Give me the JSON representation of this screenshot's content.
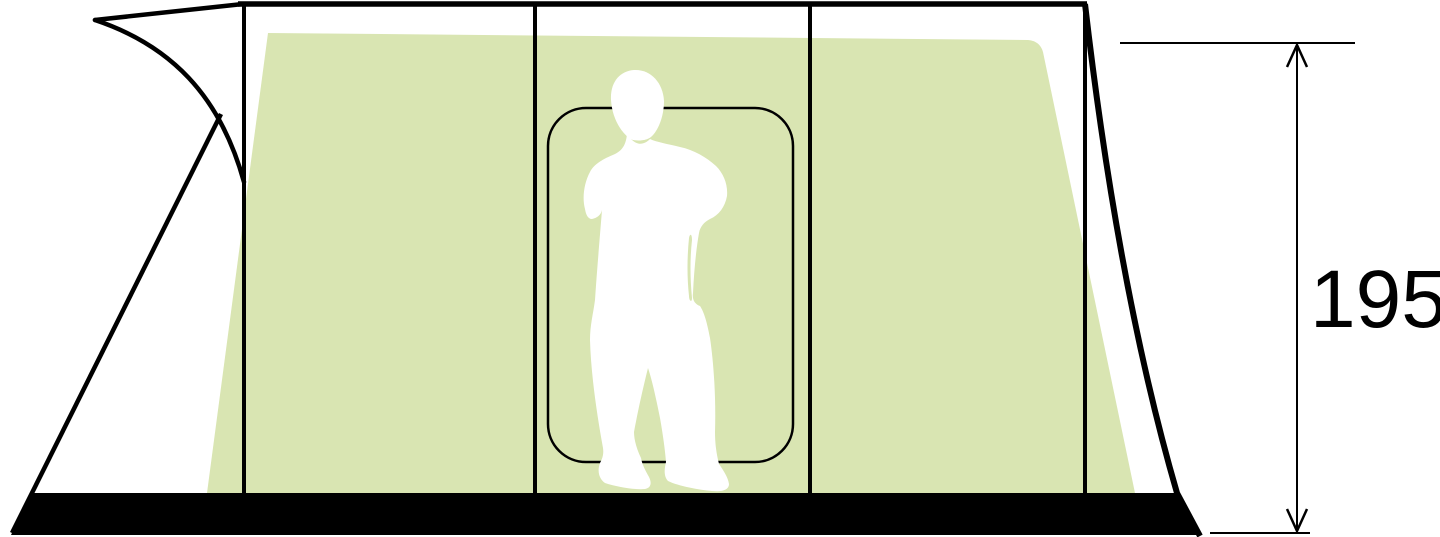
{
  "diagram": {
    "title": "tent-side-elevation-diagram",
    "dimension": {
      "label": "195"
    },
    "colors": {
      "inner_tent": "#d9e5b2",
      "outline": "#000000",
      "figure": "#ffffff",
      "background": "#ffffff"
    }
  }
}
